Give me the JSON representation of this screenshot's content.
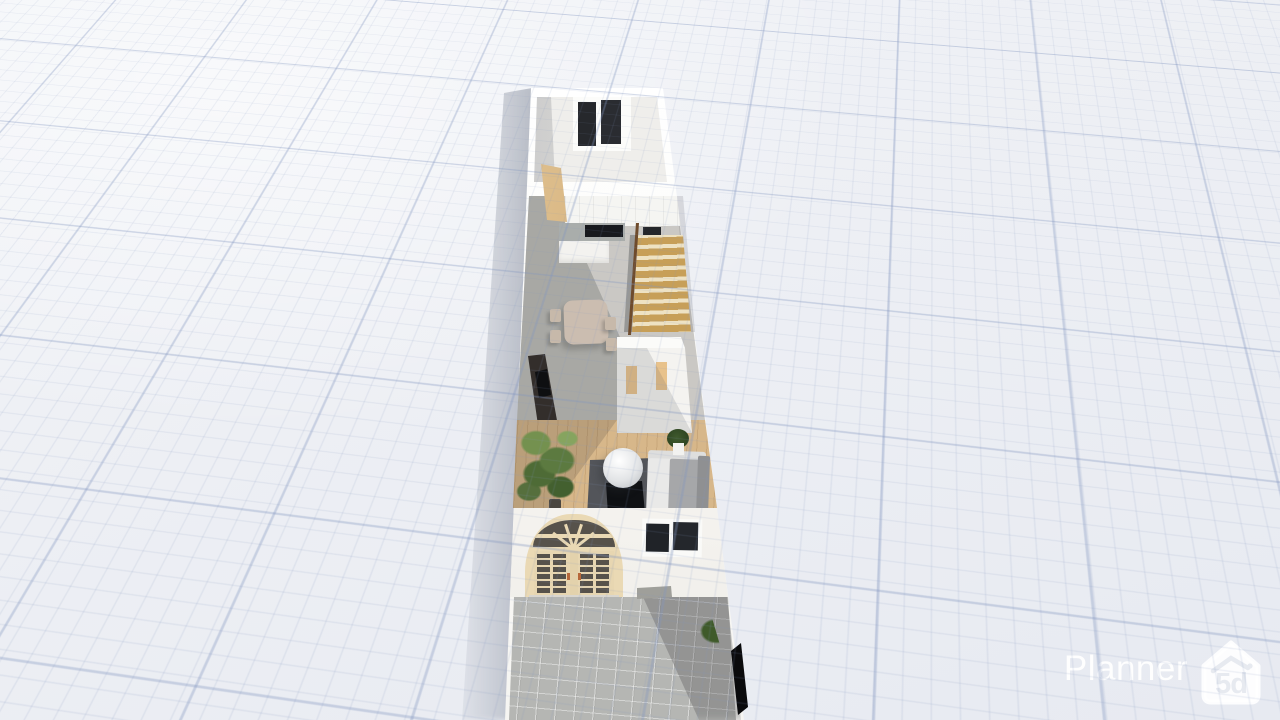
{
  "brand": {
    "name": "Planner",
    "badge": "5d"
  },
  "scene": {
    "type": "3d floor plan render",
    "view": "elevated front perspective of a narrow two-storey row house with patio",
    "rooms": [
      "bedroom",
      "kitchen",
      "dining area",
      "living room",
      "entrance",
      "patio"
    ],
    "objects": [
      "bedroom window",
      "interior wood door",
      "kitchen cabinets",
      "kitchen counter",
      "cooktop",
      "sink",
      "staircase",
      "stair railing",
      "dining table",
      "dining chairs",
      "tv cabinet",
      "shelving unit",
      "potted tree",
      "bean bag pouf",
      "area rug",
      "coffee table",
      "corner sofa",
      "sofa side plant",
      "arched french doors",
      "facade window",
      "window planter",
      "side planter",
      "patio tiles",
      "dark gate panel"
    ],
    "colors": {
      "background": "#eef0f5",
      "grid_line": "#8094be",
      "wall_white": "#fafaf8",
      "concrete_floor": "#cac8c4",
      "wood_floor": "#d7b78a",
      "stair_wood": "#c79f58",
      "interior_door_wood": "#d8b586",
      "door_frame_cream": "#ead9b4",
      "glass_dark": "#24272c",
      "sofa_gray": "#a6a7a9",
      "rug_gray": "#53555a",
      "plant_green": "#4e6b36",
      "flower_yellow": "#dcc84a",
      "patio_tile": "#b5b6b3",
      "logo_white": "#ffffff"
    }
  }
}
